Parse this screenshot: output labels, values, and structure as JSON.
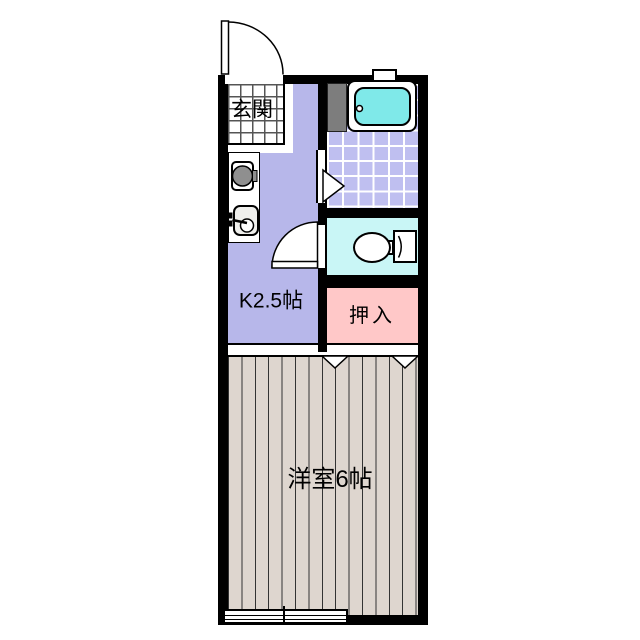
{
  "floor_plan": {
    "title": "1K apartment floor plan",
    "rooms": {
      "genkan": {
        "label": "玄関"
      },
      "kitchen": {
        "label": "K2.5帖"
      },
      "closet": {
        "label": "押入"
      },
      "western_room": {
        "label": "洋室6帖"
      }
    },
    "fixtures": [
      "bathtub",
      "washing-machine-panel",
      "kitchen-stove-burner",
      "kitchen-sink",
      "toilet",
      "entrance-door-swing",
      "toilet-door-swing",
      "bath-door-marker",
      "closet-fusuma-markers",
      "bath-window",
      "main-window"
    ],
    "colors": {
      "bg": "#ffffff",
      "wall": "#000000",
      "text": "#000000",
      "genkan_line": "#555555",
      "kitchen_floor": "#b7b7ea",
      "bath_tile": "#bfbff0",
      "tile_line": "#ffffff",
      "toilet_floor": "#c9f6f6",
      "closet_floor": "#ffc8c8",
      "wood_floor": "#ded6cf",
      "wood_line": "#333333",
      "tub_water": "#7fe9e9",
      "panel": "#7d7d7d",
      "burner": "#8f8f8f"
    }
  }
}
